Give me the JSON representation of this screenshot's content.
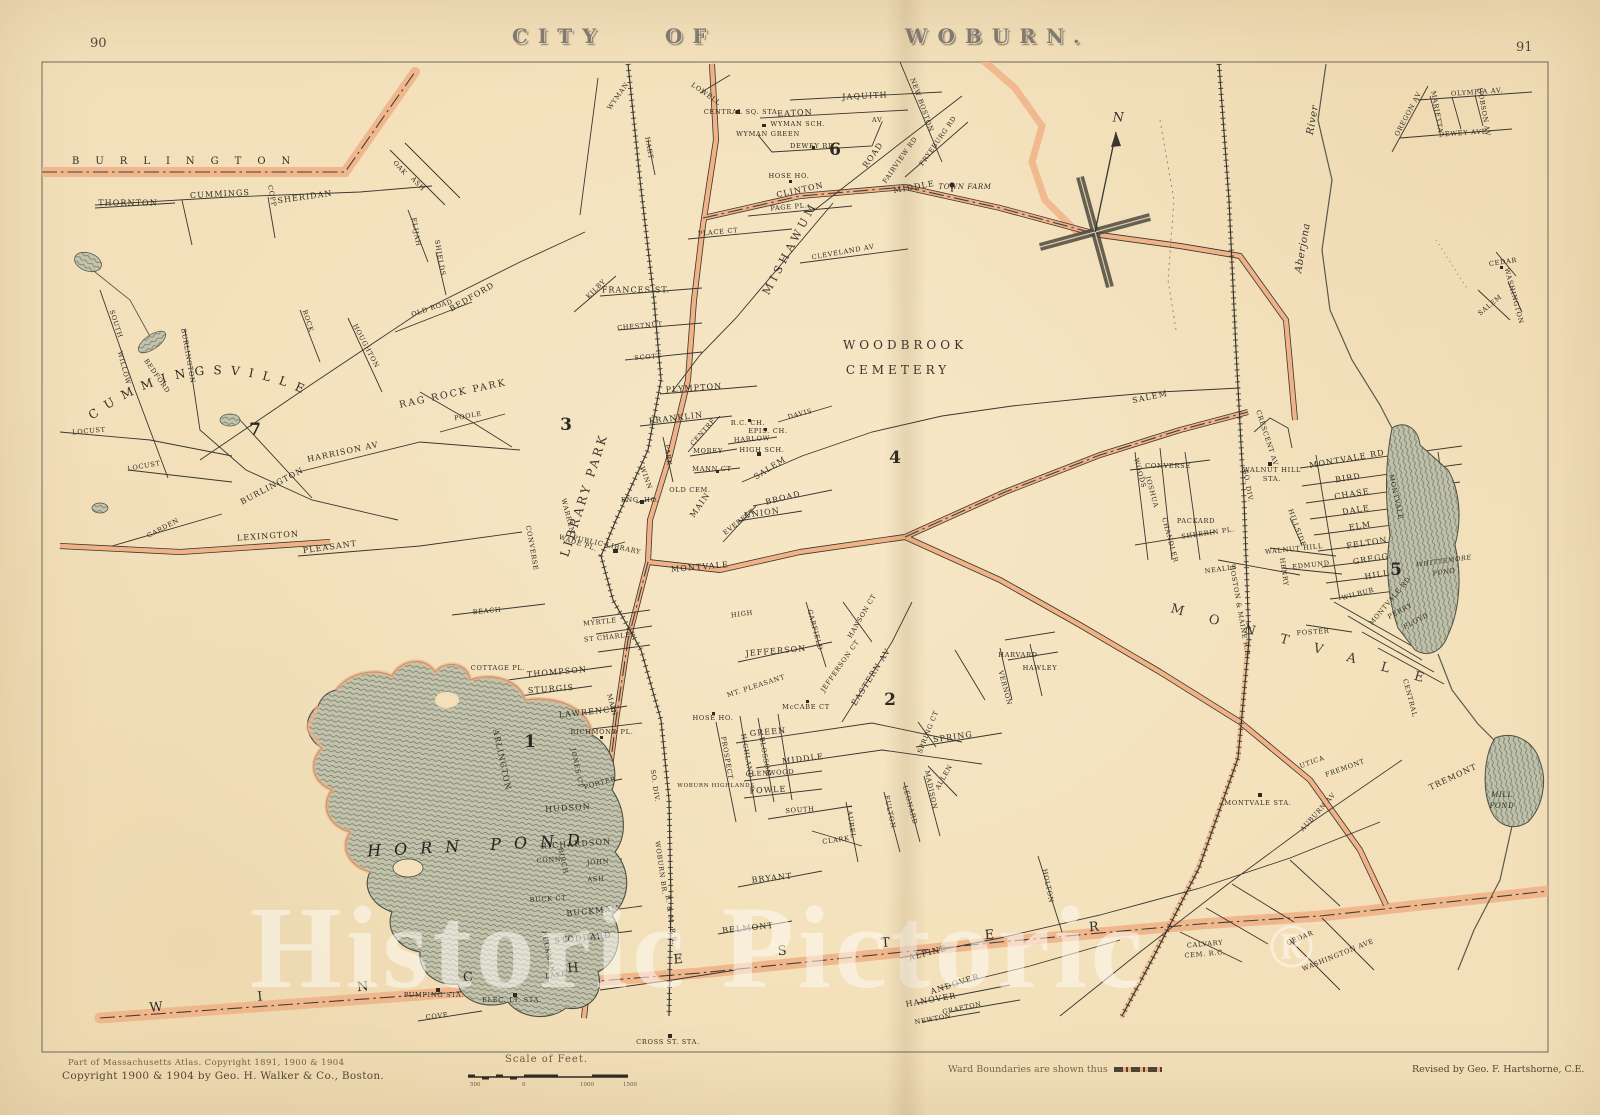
{
  "page": {
    "left_number": "90",
    "right_number": "91",
    "title_words": [
      "CITY",
      "OF",
      "WOBURN."
    ]
  },
  "margin_notes": {
    "atlas_note": "Part of Massachusetts Atlas. Copyright 1891, 1900 & 1904",
    "copyright": "Copyright 1900 & 1904 by Geo. H. Walker & Co., Boston.",
    "scale_title": "Scale of Feet.",
    "scale_labels": [
      "500",
      "0",
      "1000",
      "1500"
    ],
    "ward_note": "Ward Boundaries are shown thus",
    "revised": "Revised by Geo. F. Hartshorne, C.E."
  },
  "watermark": {
    "text": "Historic Pictoric",
    "registered": "®"
  },
  "compass": {
    "letter": "N"
  },
  "districts": {
    "burlington": "BURLINGTON",
    "winchester": "WINCHESTER",
    "cummingsville": "CUMMINGSVILLE",
    "montvale": "MONTVALE"
  },
  "wards": [
    [
      "1",
      530,
      742
    ],
    [
      "2",
      890,
      700
    ],
    [
      "3",
      566,
      425
    ],
    [
      "4",
      895,
      458
    ],
    [
      "5",
      1396,
      570
    ],
    [
      "6",
      835,
      150
    ],
    [
      "7",
      255,
      430
    ]
  ],
  "labels": [
    [
      "JAQUITH",
      865,
      96,
      -3,
      "s"
    ],
    [
      "EATON",
      795,
      113,
      -3,
      "s"
    ],
    [
      "AV.",
      878,
      120,
      0,
      "t"
    ],
    [
      "WYMAN SCH.",
      798,
      124,
      0,
      "t"
    ],
    [
      "WYMAN GREEN",
      768,
      134,
      0,
      "t"
    ],
    [
      "DEWEY RD",
      812,
      146,
      0,
      "t"
    ],
    [
      "CENTRAL SQ. STA.",
      742,
      112,
      0,
      "t"
    ],
    [
      "HOSE HO.",
      789,
      176,
      0,
      "t"
    ],
    [
      "CLINTON",
      800,
      190,
      -12,
      "s"
    ],
    [
      "PAGE PL.",
      789,
      207,
      -5,
      "t"
    ],
    [
      "PLACE CT",
      718,
      232,
      -5,
      "t"
    ],
    [
      "MIDDLE",
      914,
      187,
      -10,
      "s"
    ],
    [
      "ROAD",
      873,
      155,
      -55,
      "s"
    ],
    [
      "FAIRVIEW RD",
      900,
      160,
      -55,
      "t"
    ],
    [
      "FRYEBURG RD",
      938,
      141,
      -55,
      "t"
    ],
    [
      "NEW BOSTON",
      922,
      105,
      70,
      "t"
    ],
    [
      "CLEVELAND AV",
      843,
      252,
      -10,
      "t"
    ],
    [
      "MISHAWUM",
      790,
      248,
      -62,
      "f",
      11,
      4
    ],
    [
      "TOWN FARM",
      965,
      187,
      0,
      "i",
      7
    ],
    [
      "WYMAN",
      618,
      96,
      -55,
      "t"
    ],
    [
      "HART",
      649,
      148,
      80,
      "t"
    ],
    [
      "LOWELL",
      706,
      94,
      35,
      "t"
    ],
    [
      "FRANCES ST.",
      636,
      290,
      0,
      "s"
    ],
    [
      "KILBY",
      596,
      289,
      -45,
      "t"
    ],
    [
      "THORNTON",
      128,
      203,
      0,
      "s"
    ],
    [
      "CUMMINGS",
      220,
      194,
      -3,
      "s"
    ],
    [
      "SHERIDAN",
      305,
      197,
      -8,
      "s"
    ],
    [
      "COPP",
      272,
      196,
      78,
      "t"
    ],
    [
      "OAK",
      400,
      168,
      48,
      "t"
    ],
    [
      "ASH",
      418,
      184,
      48,
      "t"
    ],
    [
      "ELIJAH",
      416,
      232,
      80,
      "t"
    ],
    [
      "SHIELDS",
      440,
      258,
      80,
      "t"
    ],
    [
      "BEDFORD",
      472,
      297,
      -30,
      "s"
    ],
    [
      "OLD ROAD",
      432,
      308,
      -18,
      "t"
    ],
    [
      "BURLINGTON",
      188,
      356,
      80,
      "t"
    ],
    [
      "SOUTH",
      116,
      324,
      72,
      "t"
    ],
    [
      "WILLOW",
      124,
      368,
      75,
      "t"
    ],
    [
      "BEDFORD",
      157,
      376,
      55,
      "t"
    ],
    [
      "ROCK",
      308,
      321,
      72,
      "t"
    ],
    [
      "HOUGHTON",
      366,
      346,
      62,
      "t"
    ],
    [
      "LOCUST",
      89,
      431,
      -5,
      "t"
    ],
    [
      "LOCUST",
      144,
      466,
      -10,
      "t"
    ],
    [
      "HARRISON AV",
      343,
      452,
      -12,
      "s"
    ],
    [
      "BURLINGTON",
      272,
      486,
      -28,
      "s"
    ],
    [
      "GARDEN",
      163,
      528,
      -28,
      "t"
    ],
    [
      "LEXINGTON",
      268,
      536,
      -4,
      "s"
    ],
    [
      "PLEASANT",
      330,
      547,
      -8,
      "s"
    ],
    [
      "POOLE",
      468,
      416,
      -10,
      "t"
    ],
    [
      "RAG ROCK PARK",
      453,
      394,
      -12,
      "f",
      9.5,
      2
    ],
    [
      "CHESTNUT",
      640,
      326,
      -5,
      "t"
    ],
    [
      "SCOTT",
      648,
      357,
      -5,
      "t"
    ],
    [
      "PLYMPTON",
      694,
      388,
      -4,
      "s"
    ],
    [
      "FRANKLIN",
      676,
      418,
      -7,
      "s"
    ],
    [
      "CENTRE",
      703,
      432,
      -48,
      "t"
    ],
    [
      "HARLOW",
      752,
      439,
      -3,
      "t"
    ],
    [
      "MOREY",
      708,
      451,
      0,
      "t"
    ],
    [
      "MANN CT",
      712,
      469,
      0,
      "t"
    ],
    [
      "SALEM",
      770,
      468,
      -32,
      "s"
    ],
    [
      "DAVIS",
      800,
      414,
      -15,
      "t"
    ],
    [
      "EPIS. CH.",
      768,
      431,
      0,
      "t"
    ],
    [
      "R.C. CH.",
      748,
      423,
      0,
      "t"
    ],
    [
      "HIGH SCH.",
      762,
      450,
      0,
      "t"
    ],
    [
      "BROAD",
      783,
      498,
      -14,
      "s"
    ],
    [
      "UNION",
      762,
      513,
      -8,
      "s"
    ],
    [
      "EVERETT",
      739,
      522,
      -38,
      "t"
    ],
    [
      "MAIN",
      700,
      505,
      -55,
      "s"
    ],
    [
      "PARK",
      668,
      455,
      82,
      "t"
    ],
    [
      "WINN",
      646,
      478,
      70,
      "t"
    ],
    [
      "OLD CEM.",
      690,
      490,
      0,
      "t"
    ],
    [
      "ENG. HO.",
      640,
      500,
      0,
      "t"
    ],
    [
      "PUBLIC LIBRARY",
      607,
      545,
      12,
      "t"
    ],
    [
      "WADE PL.",
      578,
      543,
      18,
      "t"
    ],
    [
      "WARREN",
      568,
      516,
      75,
      "t"
    ],
    [
      "CONVERSE",
      532,
      548,
      80,
      "t"
    ],
    [
      "LIBRARY PARK",
      584,
      495,
      -72,
      "f",
      12,
      3
    ],
    [
      "MONTVALE",
      700,
      567,
      -5,
      "s"
    ],
    [
      "SALEM",
      1150,
      397,
      -12,
      "s"
    ],
    [
      "BEACH",
      487,
      611,
      -5,
      "t"
    ],
    [
      "THOMPSON",
      557,
      672,
      -5,
      "s"
    ],
    [
      "COTTAGE PL.",
      498,
      668,
      0,
      "t"
    ],
    [
      "STURGIS",
      551,
      689,
      -4,
      "s"
    ],
    [
      "LAWRENCE",
      588,
      712,
      -6,
      "s"
    ],
    [
      "RICHMOND PL.",
      602,
      732,
      0,
      "t"
    ],
    [
      "ARLINGTON",
      502,
      760,
      78,
      "s"
    ],
    [
      "JONES CT",
      577,
      768,
      78,
      "t"
    ],
    [
      "PORTER",
      600,
      783,
      -15,
      "t"
    ],
    [
      "HUDSON",
      568,
      808,
      -4,
      "s"
    ],
    [
      "RICHARDSON",
      576,
      844,
      -4,
      "s"
    ],
    [
      "JOHN",
      598,
      862,
      -4,
      "t"
    ],
    [
      "ASH",
      596,
      879,
      -4,
      "t"
    ],
    [
      "CONN",
      549,
      860,
      -4,
      "t"
    ],
    [
      "BIRCH",
      563,
      861,
      78,
      "t"
    ],
    [
      "BUCK CT",
      548,
      899,
      -3,
      "t"
    ],
    [
      "BUCKMAN",
      593,
      911,
      -6,
      "s"
    ],
    [
      "STODDARD",
      583,
      938,
      -6,
      "s"
    ],
    [
      "BUCKMAN",
      548,
      952,
      78,
      "t"
    ],
    [
      "MAIN",
      612,
      705,
      75,
      "t"
    ],
    [
      "MYRTLE",
      600,
      622,
      -6,
      "t"
    ],
    [
      "ST CHARLES",
      610,
      637,
      -6,
      "t"
    ],
    [
      "HIGH",
      742,
      614,
      -8,
      "t"
    ],
    [
      "GARFIELD",
      815,
      630,
      75,
      "t"
    ],
    [
      "HANSON CT",
      862,
      616,
      -60,
      "t"
    ],
    [
      "JEFFERSON",
      776,
      651,
      -5,
      "s"
    ],
    [
      "JEFFERSON CT",
      840,
      666,
      -55,
      "t"
    ],
    [
      "EASTERN AV",
      871,
      677,
      -58,
      "s"
    ],
    [
      "MT. PLEASANT",
      756,
      686,
      -18,
      "t"
    ],
    [
      "McCABE CT",
      806,
      707,
      0,
      "t"
    ],
    [
      "HOSE HO.",
      713,
      718,
      0,
      "t"
    ],
    [
      "GREEN",
      768,
      732,
      -5,
      "s"
    ],
    [
      "MIDDLE",
      803,
      759,
      -7,
      "s"
    ],
    [
      "GLENWOOD",
      770,
      773,
      -3,
      "t"
    ],
    [
      "FOWLE",
      768,
      790,
      -3,
      "s"
    ],
    [
      "SOUTH",
      800,
      810,
      -4,
      "t"
    ],
    [
      "PROSPECT",
      727,
      758,
      80,
      "t"
    ],
    [
      "HIGHLAND",
      747,
      756,
      80,
      "t"
    ],
    [
      "BLOSSOM",
      765,
      757,
      80,
      "t"
    ],
    [
      "SPRING CT",
      928,
      732,
      -68,
      "t"
    ],
    [
      "SPRING",
      953,
      737,
      -8,
      "s"
    ],
    [
      "ALLEN",
      944,
      777,
      -60,
      "t"
    ],
    [
      "MADISON",
      931,
      790,
      78,
      "t"
    ],
    [
      "LEONARD",
      910,
      805,
      75,
      "t"
    ],
    [
      "FULTON",
      890,
      812,
      78,
      "t"
    ],
    [
      "LAUREL",
      851,
      822,
      82,
      "t"
    ],
    [
      "CLARK",
      836,
      840,
      -8,
      "t"
    ],
    [
      "BRYANT",
      772,
      878,
      -6,
      "s"
    ],
    [
      "BELMONT",
      748,
      928,
      -6,
      "s"
    ],
    [
      "WOBURN HIGHLANDS",
      716,
      786,
      0,
      "t",
      5.5
    ],
    [
      "VERNON",
      1005,
      688,
      75,
      "t"
    ],
    [
      "HARVARD",
      1018,
      655,
      0,
      "t"
    ],
    [
      "HAWLEY",
      1040,
      668,
      0,
      "t"
    ],
    [
      "HOLTON",
      1048,
      886,
      78,
      "t"
    ],
    [
      "ALPINE",
      928,
      953,
      -15,
      "s"
    ],
    [
      "ANDOVER",
      955,
      984,
      -18,
      "s"
    ],
    [
      "HANOVER",
      931,
      1000,
      -10,
      "s"
    ],
    [
      "GRAFTON",
      962,
      1008,
      -12,
      "t"
    ],
    [
      "NEWTON",
      933,
      1019,
      -10,
      "t"
    ],
    [
      "CALVARY",
      1205,
      944,
      -5,
      "t"
    ],
    [
      "CEM. R.C.",
      1205,
      954,
      -5,
      "t"
    ],
    [
      "MONTVALE STA.",
      1258,
      803,
      0,
      "t"
    ],
    [
      "WASHINGTON AVE",
      1338,
      955,
      -22,
      "t"
    ],
    [
      "CEDAR",
      1300,
      938,
      -22,
      "t"
    ],
    [
      "UTICA",
      1312,
      762,
      -20,
      "t"
    ],
    [
      "FREMONT",
      1345,
      768,
      -20,
      "t"
    ],
    [
      "AUBURN AV",
      1318,
      812,
      -48,
      "t"
    ],
    [
      "TREMONT",
      1453,
      777,
      -25,
      "s"
    ],
    [
      "CENTRAL",
      1410,
      698,
      75,
      "t"
    ],
    [
      "CONVERSE",
      1168,
      466,
      0,
      "t"
    ],
    [
      "WOODS",
      1140,
      473,
      75,
      "t"
    ],
    [
      "JOSHUA",
      1152,
      492,
      75,
      "t"
    ],
    [
      "CHANDLER",
      1170,
      540,
      75,
      "t"
    ],
    [
      "PACKARD",
      1196,
      521,
      0,
      "t"
    ],
    [
      "SHEERIN PL.",
      1208,
      533,
      -8,
      "t"
    ],
    [
      "NEALLS",
      1221,
      569,
      -8,
      "t"
    ],
    [
      "WALNUT HILL",
      1272,
      470,
      0,
      "t"
    ],
    [
      "STA.",
      1272,
      479,
      0,
      "t"
    ],
    [
      "CRESCENT AV",
      1267,
      438,
      72,
      "t"
    ],
    [
      "MONTVALE RD",
      1347,
      459,
      -10,
      "s"
    ],
    [
      "BIRD",
      1348,
      478,
      -9,
      "s"
    ],
    [
      "CHASE",
      1352,
      494,
      -9,
      "s"
    ],
    [
      "DALE",
      1356,
      510,
      -9,
      "s"
    ],
    [
      "ELM",
      1360,
      526,
      -9,
      "s"
    ],
    [
      "FELTON",
      1367,
      543,
      -9,
      "s"
    ],
    [
      "GREGG",
      1371,
      559,
      -9,
      "s"
    ],
    [
      "HILL",
      1377,
      575,
      -9,
      "s"
    ],
    [
      "WILBUR",
      1358,
      594,
      -15,
      "t"
    ],
    [
      "MONTVALE RD",
      1390,
      601,
      -50,
      "t"
    ],
    [
      "PERRY",
      1400,
      611,
      -28,
      "t"
    ],
    [
      "FLOYD",
      1416,
      621,
      -28,
      "t"
    ],
    [
      "EDMUND",
      1311,
      565,
      -6,
      "t"
    ],
    [
      "WALNUT HILL",
      1294,
      549,
      -6,
      "t"
    ],
    [
      "HILLSIDE",
      1297,
      528,
      70,
      "t"
    ],
    [
      "HENRY",
      1284,
      572,
      82,
      "t"
    ],
    [
      "MONTVALE",
      1396,
      497,
      78,
      "t"
    ],
    [
      "FOSTER",
      1313,
      632,
      -4,
      "t"
    ],
    [
      "OLYMPIA AV.",
      1477,
      92,
      -4,
      "t"
    ],
    [
      "DEWEY AVE",
      1463,
      133,
      -4,
      "t"
    ],
    [
      "OREGON AV",
      1408,
      114,
      -62,
      "t"
    ],
    [
      "MARIETTA",
      1437,
      112,
      80,
      "t"
    ],
    [
      "HOBSON AV",
      1484,
      112,
      80,
      "t"
    ],
    [
      "CEDAR",
      1503,
      262,
      -8,
      "t"
    ],
    [
      "SALEM",
      1490,
      305,
      -40,
      "t"
    ],
    [
      "WASHINGTON",
      1514,
      296,
      75,
      "t"
    ],
    [
      "WOBURN BR.",
      661,
      868,
      82,
      "t"
    ],
    [
      "B. & M. R.R.",
      671,
      920,
      82,
      "t"
    ],
    [
      "SO. DIV.",
      655,
      786,
      82,
      "t"
    ],
    [
      "BOSTON & MAINE R.R.",
      1240,
      612,
      80,
      "t"
    ],
    [
      "SO. DIV.",
      1248,
      486,
      80,
      "t"
    ],
    [
      "CROSS ST. STA.",
      668,
      1042,
      0,
      "t"
    ],
    [
      "PUMPING STA.",
      434,
      995,
      0,
      "t"
    ],
    [
      "ELEC. LT. STA.",
      512,
      1000,
      0,
      "t"
    ],
    [
      "LAKE",
      556,
      975,
      -6,
      "t"
    ],
    [
      "COVE",
      437,
      1016,
      -6,
      "t"
    ],
    [
      "Aberjona",
      1303,
      248,
      -80,
      "i",
      10
    ],
    [
      "River",
      1313,
      120,
      -80,
      "i",
      10
    ],
    [
      "WOODBROOK",
      905,
      345,
      0,
      "f",
      12,
      4
    ],
    [
      "CEMETERY",
      898,
      370,
      0,
      "f",
      12,
      4
    ],
    [
      "WHITTEMORE",
      1444,
      561,
      -8,
      "i",
      6.5
    ],
    [
      "POND",
      1444,
      572,
      -8,
      "i",
      6.5
    ],
    [
      "MILL",
      1502,
      795,
      0,
      "i",
      7
    ],
    [
      "POND",
      1502,
      806,
      0,
      "i",
      7
    ],
    [
      "HORN POND",
      480,
      845,
      -3,
      "b"
    ]
  ]
}
